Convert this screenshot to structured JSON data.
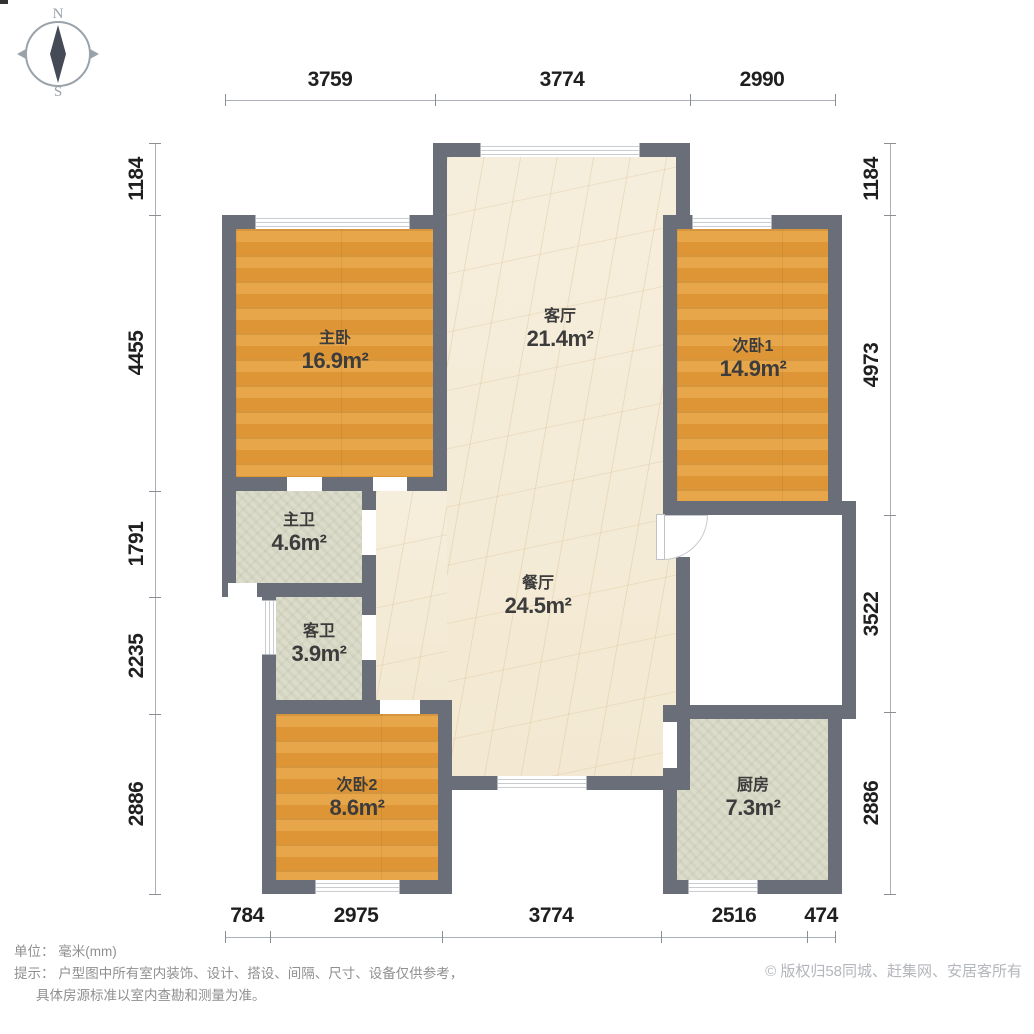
{
  "compass": {
    "north": "N",
    "south": "S"
  },
  "rooms": [
    {
      "name": "主卧",
      "area": "16.9m²"
    },
    {
      "name": "客厅",
      "area": "21.4m²"
    },
    {
      "name": "次卧1",
      "area": "14.9m²"
    },
    {
      "name": "主卫",
      "area": "4.6m²"
    },
    {
      "name": "客卫",
      "area": "3.9m²"
    },
    {
      "name": "餐厅",
      "area": "24.5m²"
    },
    {
      "name": "次卧2",
      "area": "8.6m²"
    },
    {
      "name": "厨房",
      "area": "7.3m²"
    }
  ],
  "dimensions": {
    "top": [
      "3759",
      "3774",
      "2990"
    ],
    "bottom": [
      "784",
      "2975",
      "3774",
      "2516",
      "474"
    ],
    "left": [
      "1184",
      "4455",
      "1791",
      "2235",
      "2886"
    ],
    "right": [
      "1184",
      "4973",
      "3522",
      "2886"
    ]
  },
  "footer": {
    "unit_label": "单位：",
    "unit_value": "毫米(mm)",
    "hint_label": "提示：",
    "hint_line1": "户型图中所有室内装饰、设计、搭设、间隔、尺寸、设备仅供参考，",
    "hint_line2": "具体房源标准以室内查勘和测量为准。",
    "copyright": "© 版权归58同城、赶集网、安居客所有"
  },
  "colors": {
    "wall": "#696e78",
    "wood_floor": "#e29c3e",
    "marble_floor": "#f5ecda",
    "tile_floor": "#dcdccb",
    "dimension_text": "#1f1f1f",
    "footer_text": "#8f8f8f",
    "copyright_text": "#b3b6bb"
  }
}
